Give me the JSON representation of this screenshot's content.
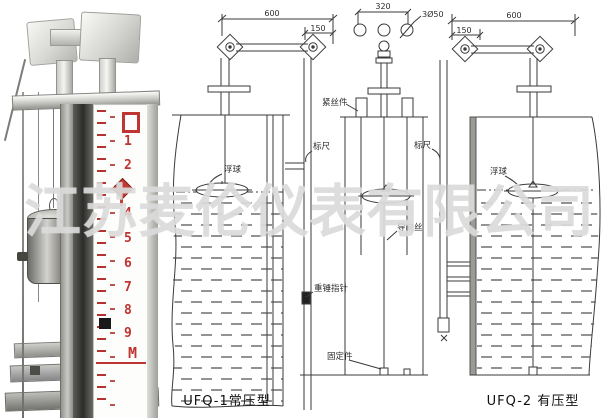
{
  "watermark": "江苏麦伦仪表有限公司",
  "photo": {
    "scale_numbers": [
      "1",
      "2",
      "4",
      "5",
      "6",
      "7",
      "8",
      "9"
    ],
    "scale_unit": "M"
  },
  "ufq1": {
    "caption": "UFQ-1常压型",
    "dim_width": "600",
    "dim_offset": "150",
    "label_float": "浮球",
    "label_scale": "标尺",
    "label_weight_pointer": "重锤指针"
  },
  "detail": {
    "dim_pitch": "320",
    "dim_holes": "3Ø50",
    "label_tensioner": "紧丝件",
    "label_guide_wire": "导向丝",
    "label_anchor": "固定件"
  },
  "ufq2": {
    "caption": "UFQ-2 有压型",
    "dim_width": "600",
    "dim_offset": "150",
    "label_scale": "标尺",
    "label_float": "浮球"
  },
  "colors": {
    "line": "#3a3a3a",
    "scale_red": "#bf3531",
    "watermark_gray": "#d6d6d6"
  }
}
